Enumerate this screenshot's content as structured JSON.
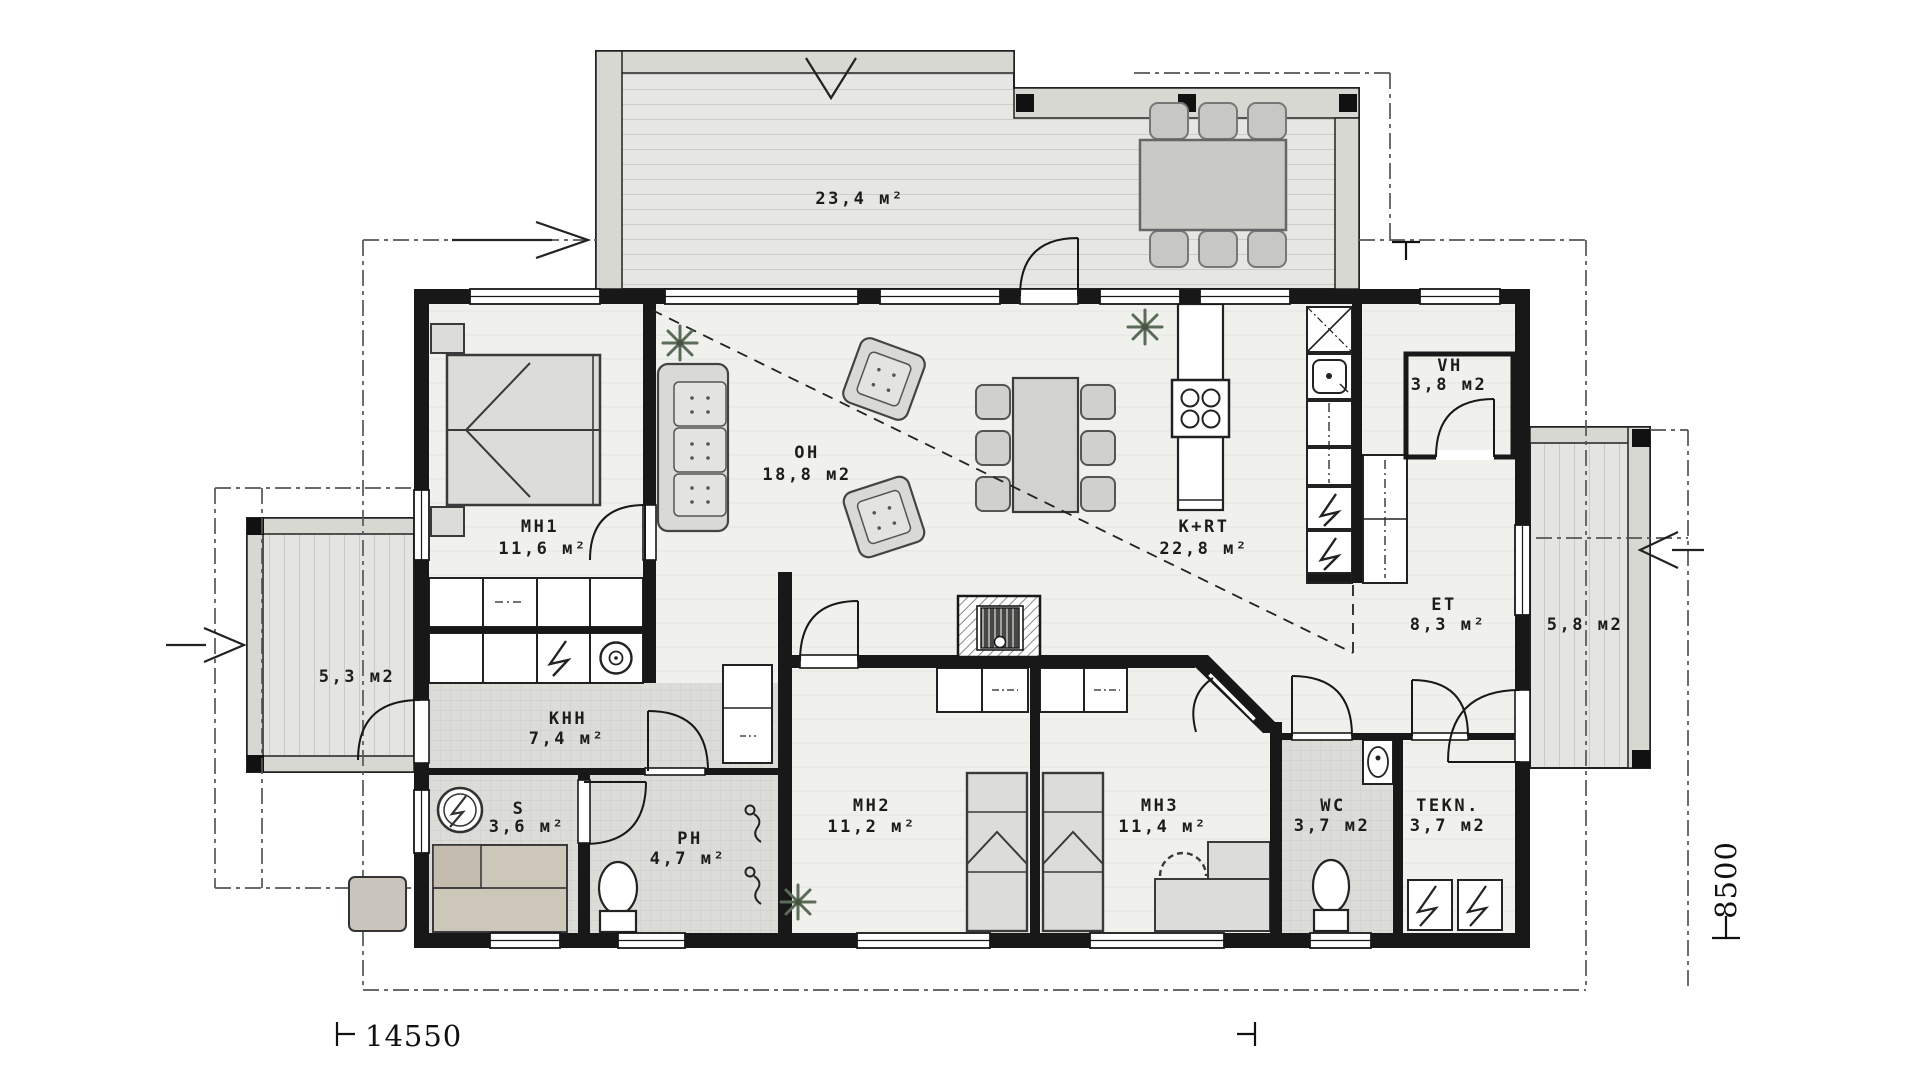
{
  "plan_title": "single-storey house floor plan",
  "rooms": {
    "terrace_top": {
      "area": "23,4 м²"
    },
    "mh1": {
      "label": "MH1",
      "area": "11,6 м²"
    },
    "oh": {
      "label": "OH",
      "area": "18,8 м2"
    },
    "krt": {
      "label": "K+RT",
      "area": "22,8 м²"
    },
    "vh": {
      "label": "VH",
      "area": "3,8 м2"
    },
    "et": {
      "label": "ET",
      "area": "8,3 м²"
    },
    "terrace_right": {
      "area": "5,8 м2"
    },
    "terrace_left": {
      "area": "5,3 м2"
    },
    "khh": {
      "label": "KHH",
      "area": "7,4 м²"
    },
    "s": {
      "label": "S",
      "area": "3,6 м²"
    },
    "ph": {
      "label": "PH",
      "area": "4,7 м²"
    },
    "mh2": {
      "label": "MH2",
      "area": "11,2 м²"
    },
    "mh3": {
      "label": "MH3",
      "area": "11,4 м²"
    },
    "wc": {
      "label": "WC",
      "area": "3,7 м2"
    },
    "tekn": {
      "label": "TEKN.",
      "area": "3,7 м2"
    }
  },
  "dimensions": {
    "width_mm": "14550",
    "height_mm": "8500"
  },
  "colors": {
    "walls": "#181818",
    "floor": "#f0f0ed",
    "tile": "#dcdcd9",
    "deck": "#e6e6e2",
    "furniture": "#d9d9d6",
    "sauna_bench": "#cdc7ba",
    "plant": "#5a6b57",
    "dashdot_line": "#555555"
  }
}
